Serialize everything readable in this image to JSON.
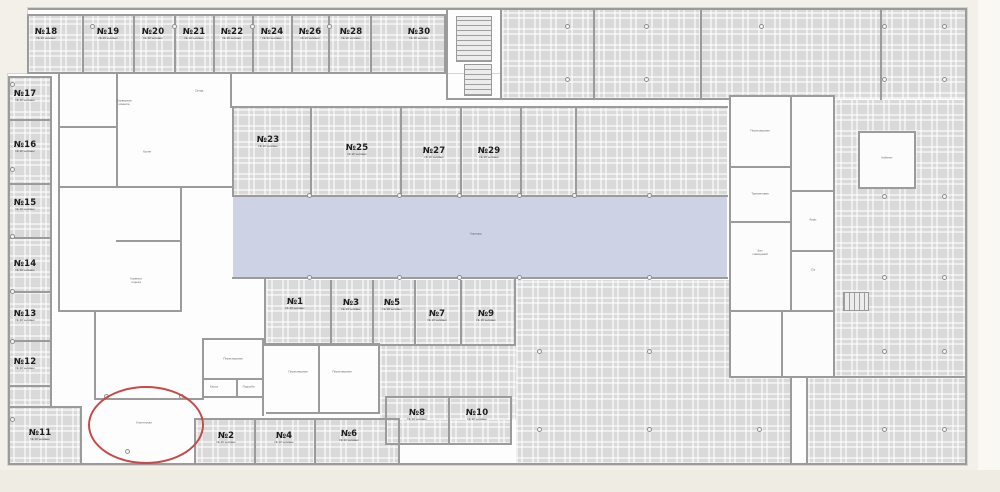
{
  "labels": {
    "corridor": "Коридор",
    "room_subtitle": "№ 10 человек"
  },
  "palette": {
    "zone_gray": "#d9d9d9",
    "wall_gray": "#9b9b9b",
    "corridor_blue": "#cdd3e4",
    "annotation_red": "#c74a4a",
    "background": "#f3f0e9"
  },
  "rooms": [
    {
      "label": "№18",
      "x": 46,
      "y": 36
    },
    {
      "label": "№19",
      "x": 108,
      "y": 36
    },
    {
      "label": "№20",
      "x": 153,
      "y": 36
    },
    {
      "label": "№21",
      "x": 194,
      "y": 36
    },
    {
      "label": "№22",
      "x": 232,
      "y": 36
    },
    {
      "label": "№24",
      "x": 272,
      "y": 36
    },
    {
      "label": "№26",
      "x": 310,
      "y": 36
    },
    {
      "label": "№28",
      "x": 351,
      "y": 36
    },
    {
      "label": "№30",
      "x": 419,
      "y": 36
    },
    {
      "label": "№17",
      "x": 25,
      "y": 98
    },
    {
      "label": "№16",
      "x": 25,
      "y": 149
    },
    {
      "label": "№15",
      "x": 25,
      "y": 207
    },
    {
      "label": "№14",
      "x": 25,
      "y": 268
    },
    {
      "label": "№13",
      "x": 25,
      "y": 318
    },
    {
      "label": "№12",
      "x": 25,
      "y": 366
    },
    {
      "label": "№11",
      "x": 40,
      "y": 437
    },
    {
      "label": "№23",
      "x": 268,
      "y": 144
    },
    {
      "label": "№25",
      "x": 357,
      "y": 152
    },
    {
      "label": "№27",
      "x": 434,
      "y": 155
    },
    {
      "label": "№29",
      "x": 489,
      "y": 155
    },
    {
      "label": "№1",
      "x": 295,
      "y": 306
    },
    {
      "label": "№3",
      "x": 351,
      "y": 307
    },
    {
      "label": "№5",
      "x": 392,
      "y": 307
    },
    {
      "label": "№7",
      "x": 437,
      "y": 318
    },
    {
      "label": "№9",
      "x": 486,
      "y": 318
    },
    {
      "label": "№8",
      "x": 417,
      "y": 417
    },
    {
      "label": "№10",
      "x": 477,
      "y": 417
    },
    {
      "label": "№2",
      "x": 226,
      "y": 440
    },
    {
      "label": "№4",
      "x": 284,
      "y": 440
    },
    {
      "label": "№6",
      "x": 349,
      "y": 438
    }
  ],
  "micro_labels": [
    {
      "text": "Коридор",
      "x": 476,
      "y": 234,
      "tone": "blue"
    },
    {
      "text": "Серверная\nкомната",
      "x": 124,
      "y": 103,
      "tone": ""
    },
    {
      "text": "Склад",
      "x": 199,
      "y": 91,
      "tone": ""
    },
    {
      "text": "Кухня",
      "x": 147,
      "y": 152,
      "tone": ""
    },
    {
      "text": "Комната\nотдыха",
      "x": 136,
      "y": 281,
      "tone": ""
    },
    {
      "text": "Переговорная",
      "x": 233,
      "y": 359,
      "tone": ""
    },
    {
      "text": "Переговорная",
      "x": 298,
      "y": 372,
      "tone": ""
    },
    {
      "text": "Переговорная",
      "x": 342,
      "y": 372,
      "tone": ""
    },
    {
      "text": "Касса",
      "x": 214,
      "y": 387,
      "tone": ""
    },
    {
      "text": "Подсобн.",
      "x": 249,
      "y": 387,
      "tone": ""
    },
    {
      "text": "Переговорная",
      "x": 760,
      "y": 131,
      "tone": ""
    },
    {
      "text": "Тренинговая",
      "x": 760,
      "y": 194,
      "tone": ""
    },
    {
      "text": "Зал\nсовещаний",
      "x": 760,
      "y": 253,
      "tone": ""
    },
    {
      "text": "Кабинет",
      "x": 887,
      "y": 158,
      "tone": ""
    },
    {
      "text": "Лифт",
      "x": 813,
      "y": 220,
      "tone": ""
    },
    {
      "text": "С/у",
      "x": 813,
      "y": 270,
      "tone": ""
    }
  ],
  "annotation": {
    "shape": "ellipse",
    "label": "Клиентская",
    "x": 88,
    "y": 386,
    "w": 112,
    "h": 74,
    "color": "#c74a4a"
  },
  "layout": {
    "plan_bg": [
      [
        28,
        8,
        939,
        66
      ],
      [
        8,
        74,
        959,
        391
      ]
    ],
    "gray_zones": [
      [
        28,
        16,
        417,
        57
      ],
      [
        8,
        78,
        43,
        328
      ],
      [
        8,
        408,
        73,
        56
      ],
      [
        502,
        10,
        463,
        89
      ],
      [
        232,
        108,
        495,
        88
      ],
      [
        835,
        100,
        130,
        277
      ],
      [
        808,
        378,
        157,
        86
      ],
      [
        266,
        280,
        249,
        64
      ],
      [
        516,
        280,
        213,
        184
      ],
      [
        729,
        378,
        61,
        86
      ],
      [
        196,
        420,
        203,
        44
      ],
      [
        386,
        398,
        125,
        46
      ],
      [
        380,
        345,
        136,
        75
      ]
    ],
    "corridor": [
      233,
      197,
      494,
      80
    ],
    "white_zones": [
      [
        729,
        95,
        106,
        283
      ],
      [
        858,
        131,
        58,
        58
      ]
    ],
    "walls": [
      [
        28,
        14,
        418,
        2
      ],
      [
        28,
        72,
        418,
        2
      ],
      [
        27,
        14,
        2,
        60
      ],
      [
        444,
        14,
        2,
        60
      ],
      [
        82,
        16,
        2,
        56
      ],
      [
        133,
        16,
        2,
        56
      ],
      [
        174,
        16,
        2,
        56
      ],
      [
        213,
        16,
        2,
        56
      ],
      [
        252,
        16,
        2,
        56
      ],
      [
        291,
        16,
        2,
        56
      ],
      [
        328,
        16,
        2,
        56
      ],
      [
        370,
        16,
        2,
        56
      ],
      [
        8,
        76,
        2,
        389
      ],
      [
        50,
        76,
        2,
        332
      ],
      [
        8,
        76,
        44,
        2
      ],
      [
        8,
        119,
        44,
        2
      ],
      [
        8,
        183,
        44,
        2
      ],
      [
        8,
        237,
        44,
        2
      ],
      [
        8,
        291,
        44,
        2
      ],
      [
        8,
        340,
        44,
        2
      ],
      [
        8,
        385,
        44,
        2
      ],
      [
        8,
        406,
        74,
        2
      ],
      [
        80,
        406,
        2,
        59
      ],
      [
        28,
        8,
        939,
        2
      ],
      [
        965,
        8,
        2,
        457
      ],
      [
        8,
        463,
        959,
        2
      ],
      [
        446,
        10,
        2,
        90
      ],
      [
        500,
        10,
        2,
        90
      ],
      [
        446,
        98,
        58,
        2
      ],
      [
        593,
        10,
        2,
        90
      ],
      [
        700,
        10,
        2,
        90
      ],
      [
        880,
        10,
        2,
        90
      ],
      [
        500,
        98,
        231,
        2
      ],
      [
        232,
        106,
        496,
        2
      ],
      [
        232,
        106,
        2,
        91
      ],
      [
        310,
        108,
        2,
        89
      ],
      [
        400,
        108,
        2,
        89
      ],
      [
        460,
        108,
        2,
        89
      ],
      [
        520,
        108,
        2,
        89
      ],
      [
        575,
        108,
        2,
        89
      ],
      [
        232,
        195,
        496,
        2
      ],
      [
        232,
        277,
        496,
        2
      ],
      [
        264,
        278,
        2,
        68
      ],
      [
        330,
        280,
        2,
        64
      ],
      [
        372,
        280,
        2,
        64
      ],
      [
        414,
        280,
        2,
        64
      ],
      [
        460,
        280,
        2,
        64
      ],
      [
        514,
        278,
        2,
        68
      ],
      [
        264,
        344,
        252,
        2
      ],
      [
        194,
        418,
        206,
        2
      ],
      [
        194,
        418,
        2,
        47
      ],
      [
        254,
        420,
        2,
        45
      ],
      [
        314,
        420,
        2,
        45
      ],
      [
        398,
        420,
        2,
        45
      ],
      [
        385,
        396,
        127,
        2
      ],
      [
        385,
        396,
        2,
        49
      ],
      [
        448,
        396,
        2,
        49
      ],
      [
        510,
        396,
        2,
        49
      ],
      [
        385,
        443,
        127,
        2
      ],
      [
        806,
        376,
        161,
        2
      ],
      [
        806,
        376,
        2,
        89
      ],
      [
        790,
        376,
        2,
        89
      ],
      [
        833,
        98,
        2,
        280
      ],
      [
        58,
        72,
        2,
        240
      ],
      [
        58,
        72,
        176,
        2
      ],
      [
        230,
        72,
        2,
        36
      ],
      [
        116,
        74,
        2,
        114
      ],
      [
        58,
        126,
        60,
        2
      ],
      [
        58,
        186,
        174,
        2
      ],
      [
        180,
        186,
        2,
        126
      ],
      [
        116,
        240,
        66,
        2
      ],
      [
        58,
        310,
        124,
        2
      ],
      [
        94,
        310,
        2,
        90
      ],
      [
        94,
        398,
        108,
        2
      ],
      [
        202,
        338,
        2,
        62
      ],
      [
        202,
        338,
        62,
        2
      ],
      [
        202,
        378,
        62,
        2
      ],
      [
        202,
        396,
        62,
        2
      ],
      [
        236,
        378,
        2,
        20
      ],
      [
        262,
        338,
        2,
        78
      ],
      [
        266,
        343,
        114,
        2
      ],
      [
        318,
        343,
        2,
        71
      ],
      [
        378,
        343,
        2,
        71
      ],
      [
        266,
        412,
        114,
        2
      ],
      [
        790,
        95,
        2,
        217
      ],
      [
        729,
        166,
        62,
        2
      ],
      [
        729,
        221,
        62,
        2
      ],
      [
        729,
        310,
        106,
        2
      ],
      [
        781,
        310,
        2,
        68
      ],
      [
        792,
        190,
        43,
        2
      ],
      [
        792,
        250,
        43,
        2
      ]
    ],
    "stairs": [
      [
        456,
        16,
        36,
        46,
        "v"
      ],
      [
        464,
        64,
        28,
        32,
        "v"
      ],
      [
        843,
        292,
        26,
        19,
        "h"
      ]
    ],
    "dots": [
      [
        13,
        85
      ],
      [
        13,
        170
      ],
      [
        13,
        237
      ],
      [
        13,
        292
      ],
      [
        13,
        342
      ],
      [
        13,
        420
      ],
      [
        93,
        27
      ],
      [
        175,
        27
      ],
      [
        253,
        27
      ],
      [
        330,
        27
      ],
      [
        568,
        27
      ],
      [
        647,
        27
      ],
      [
        762,
        27
      ],
      [
        885,
        27
      ],
      [
        945,
        27
      ],
      [
        568,
        80
      ],
      [
        647,
        80
      ],
      [
        885,
        80
      ],
      [
        945,
        80
      ],
      [
        310,
        196
      ],
      [
        400,
        196
      ],
      [
        460,
        196
      ],
      [
        520,
        196
      ],
      [
        575,
        196
      ],
      [
        650,
        196
      ],
      [
        310,
        278
      ],
      [
        400,
        278
      ],
      [
        460,
        278
      ],
      [
        520,
        278
      ],
      [
        650,
        278
      ],
      [
        885,
        197
      ],
      [
        945,
        197
      ],
      [
        885,
        278
      ],
      [
        945,
        278
      ],
      [
        885,
        352
      ],
      [
        945,
        352
      ],
      [
        885,
        430
      ],
      [
        945,
        430
      ],
      [
        540,
        352
      ],
      [
        650,
        352
      ],
      [
        540,
        430
      ],
      [
        650,
        430
      ],
      [
        760,
        430
      ],
      [
        107,
        397
      ],
      [
        182,
        397
      ],
      [
        128,
        452
      ]
    ]
  }
}
